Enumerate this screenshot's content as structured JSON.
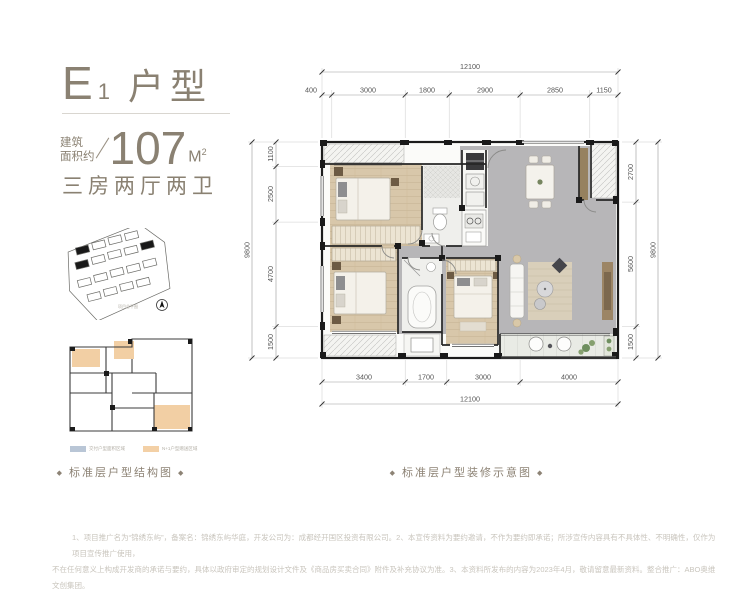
{
  "unit": {
    "title_letter": "E",
    "title_number": "1",
    "title_type": "户型",
    "area_label_top": "建筑",
    "area_label_bottom": "面积约",
    "area_value": "107",
    "area_unit": "M",
    "area_unit_exp": "2",
    "layout_desc": "三房两厅两卫"
  },
  "site_plan": {
    "note": "项目总平图"
  },
  "diagrams": {
    "left_caption": "标准层户型结构图",
    "right_caption": "标准层户型装修示意图",
    "diamond": "◆",
    "legend": [
      {
        "label": "交付户型面积区域",
        "color": "#b9c6d6"
      },
      {
        "label": "N+1户型赠送区域",
        "color": "#f3d0a6"
      }
    ]
  },
  "dimensions": {
    "top": {
      "total": "12100",
      "segments": [
        "400",
        "3000",
        "1800",
        "2900",
        "2850",
        "1150"
      ]
    },
    "bottom": {
      "total": "12100",
      "segments": [
        "3400",
        "1700",
        "3000",
        "4000"
      ]
    },
    "left": {
      "total": "9800",
      "segments": [
        "1100",
        "2500",
        "4700",
        "1500"
      ]
    },
    "right": {
      "total": "9800",
      "segments": [
        "2700",
        "5600",
        "1500"
      ]
    }
  },
  "disclaimer": {
    "line1": "1、项目推广名为“锦绣东屿”，备案名：锦绣东屿华庭，开发公司为：成都经开国区投资有限公司。2、本宣传资料为要约邀请，不作为要约即承诺；所涉宣传内容具有不具体性、不明确性，仅作为项目宣传推广使用，",
    "line2": "不在任何意义上构成开发商的承诺与要约，具体以政府审定的规划设计文件及《商品房买卖合同》附件及补充协议为准。3、本资料所发布的内容为2023年4月，敬请留意最新资料。整合推广：ABO奥维文创集团。"
  },
  "colors": {
    "accent": "#8a8172",
    "wood": "#d8c7aa",
    "tile": "#b7b6b8",
    "wall": "#1c1c1c"
  }
}
